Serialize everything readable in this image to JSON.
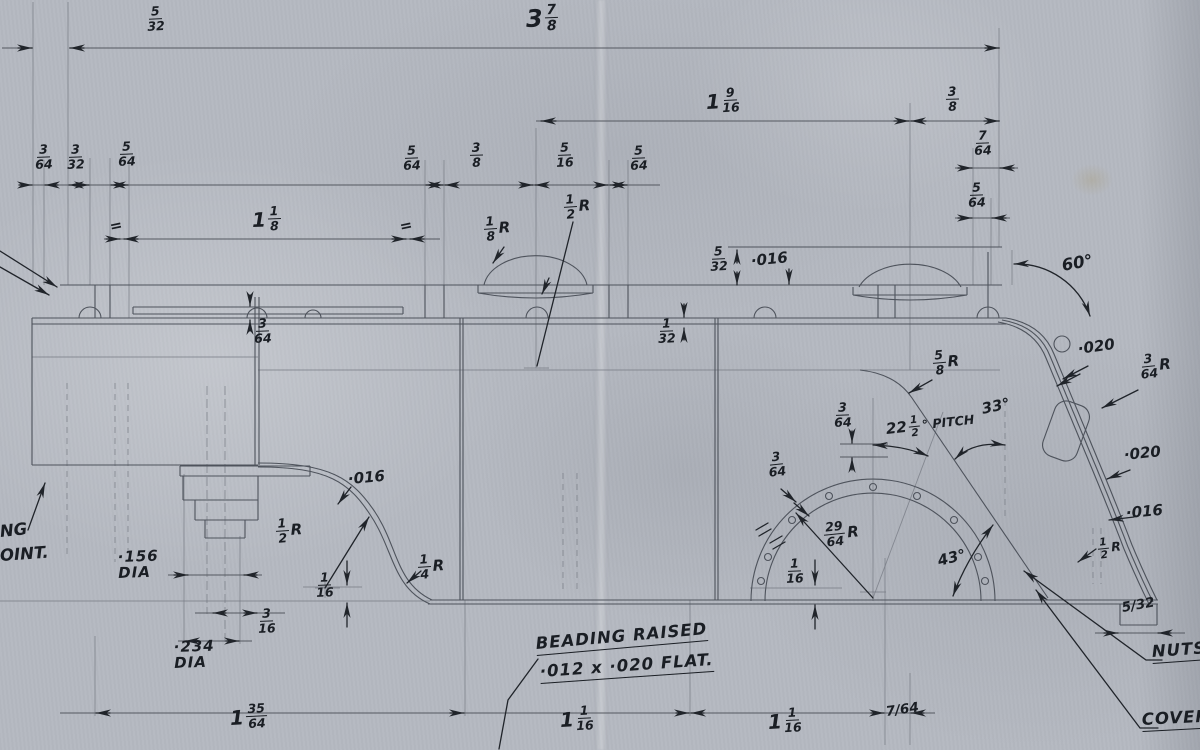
{
  "colors": {
    "paper": "#b5b9c1",
    "ink": "#1a1e24",
    "pencil": "#4e535c"
  },
  "labels": [
    {
      "id": "dim-5-32-top",
      "num": "5",
      "den": "32"
    },
    {
      "id": "dim-3-7-8",
      "whole": "3",
      "num": "7",
      "den": "8"
    },
    {
      "id": "dim-1-9-16",
      "whole": "1",
      "num": "9",
      "den": "16"
    },
    {
      "id": "dim-3-8-top",
      "num": "3",
      "den": "8"
    },
    {
      "id": "dim-7-64-top",
      "num": "7",
      "den": "64"
    },
    {
      "id": "dim-5-64-right",
      "num": "5",
      "den": "64"
    },
    {
      "id": "dim-3-64-left",
      "num": "3",
      "den": "64"
    },
    {
      "id": "dim-3-32-left",
      "num": "3",
      "den": "32"
    },
    {
      "id": "dim-5-64-left",
      "num": "5",
      "den": "64"
    },
    {
      "id": "dim-5-64-mid1",
      "num": "5",
      "den": "64"
    },
    {
      "id": "dim-3-8-mid",
      "num": "3",
      "den": "8"
    },
    {
      "id": "dim-5-16-mid",
      "num": "5",
      "den": "16"
    },
    {
      "id": "dim-5-64-mid2",
      "num": "5",
      "den": "64"
    },
    {
      "id": "dim-1-1-8",
      "whole": "1",
      "num": "1",
      "den": "8"
    },
    {
      "id": "equal-mark-left",
      "text": "="
    },
    {
      "id": "equal-mark-right",
      "text": "="
    },
    {
      "id": "radius-1-8",
      "num": "1",
      "den": "8",
      "suffix": "R"
    },
    {
      "id": "radius-1-2-dome",
      "num": "1",
      "den": "2",
      "suffix": "R"
    },
    {
      "id": "dim-5-32-dome",
      "num": "5",
      "den": "32"
    },
    {
      "id": "val-016-dome",
      "text": "·016"
    },
    {
      "id": "angle-60",
      "text": "60°"
    },
    {
      "id": "dim-3-64-strip",
      "num": "3",
      "den": "64"
    },
    {
      "id": "dim-1-32",
      "num": "1",
      "den": "32"
    },
    {
      "id": "val-020-upper",
      "text": "·020"
    },
    {
      "id": "radius-3-64",
      "num": "3",
      "den": "64",
      "suffix": "R"
    },
    {
      "id": "radius-5-8",
      "num": "5",
      "den": "8",
      "suffix": "R"
    },
    {
      "id": "angle-33",
      "text": "33°"
    },
    {
      "id": "dim-3-64-pitch",
      "num": "3",
      "den": "64"
    },
    {
      "id": "pitch-22-5",
      "whole": "22",
      "num": "1",
      "den": "2",
      "suffix": "° PITCH"
    },
    {
      "id": "val-020-lower",
      "text": "·020"
    },
    {
      "id": "dim-3-64-arch",
      "num": "3",
      "den": "64"
    },
    {
      "id": "val-016-scurve",
      "text": "·016"
    },
    {
      "id": "radius-29-64",
      "num": "29",
      "den": "64",
      "suffix": "R"
    },
    {
      "id": "val-016-slope",
      "text": "·016"
    },
    {
      "id": "radius-1-2-slope",
      "num": "1",
      "den": "2",
      "suffix": "R"
    },
    {
      "id": "radius-1-2-scurve",
      "num": "1",
      "den": "2",
      "suffix": "R"
    },
    {
      "id": "dim-1-16-scurve",
      "num": "1",
      "den": "16"
    },
    {
      "id": "radius-1-4",
      "num": "1",
      "den": "4",
      "suffix": "R"
    },
    {
      "id": "dia-156",
      "line1": "·156",
      "line2": "DIA"
    },
    {
      "id": "dim-1-16-arch",
      "num": "1",
      "den": "16"
    },
    {
      "id": "angle-43",
      "text": "43°"
    },
    {
      "id": "dim-3-16",
      "num": "3",
      "den": "16"
    },
    {
      "id": "dim-5-32-rear",
      "text": "5/32"
    },
    {
      "id": "dia-234",
      "line1": "·234",
      "line2": "DIA"
    },
    {
      "id": "note-edge-1",
      "text": "NG"
    },
    {
      "id": "note-edge-2",
      "text": "OINT."
    },
    {
      "id": "note-nuts",
      "text": "NUTS"
    },
    {
      "id": "note-beading-1",
      "text": "BEADING RAISED"
    },
    {
      "id": "note-beading-2",
      "text": "·012 x ·020 FLAT."
    },
    {
      "id": "dim-1-35-64",
      "whole": "1",
      "num": "35",
      "den": "64"
    },
    {
      "id": "dim-1-1-16-a",
      "whole": "1",
      "num": "1",
      "den": "16"
    },
    {
      "id": "dim-1-1-16-b",
      "whole": "1",
      "num": "1",
      "den": "16"
    },
    {
      "id": "dim-7-64-bottom",
      "text": "7/64"
    },
    {
      "id": "note-cover",
      "text": "COVER"
    }
  ]
}
